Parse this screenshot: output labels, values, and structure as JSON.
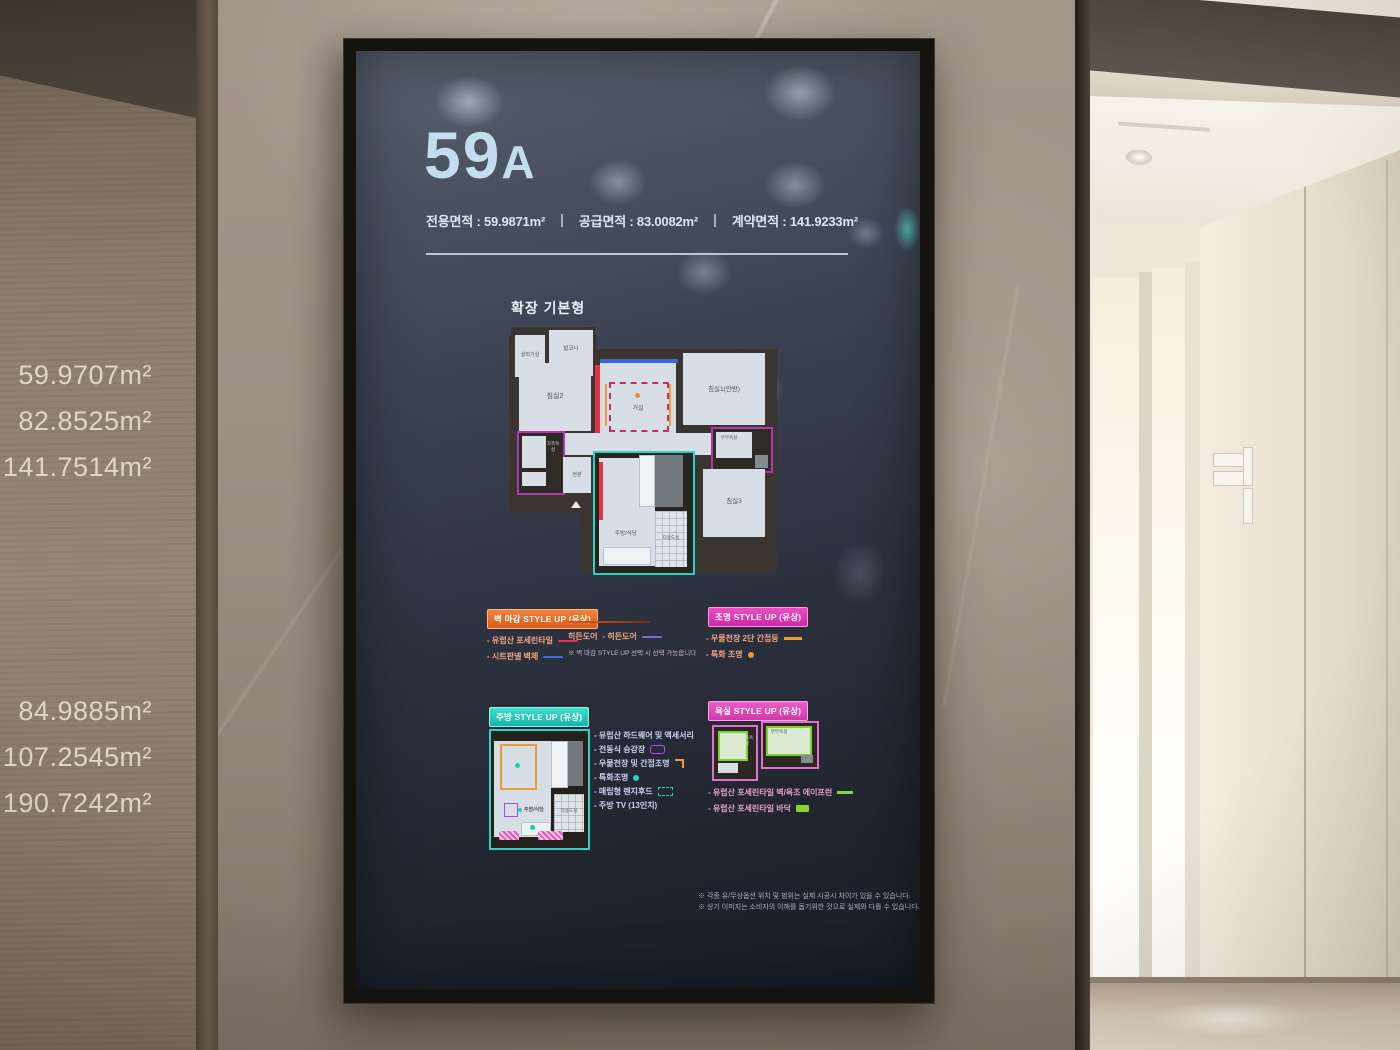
{
  "colors": {
    "wall_badge_orange": "#e8722b",
    "lighting_badge_magenta": "#d936b5",
    "kitchen_badge_teal": "#2dd2c2",
    "bath_badge_pink": "#dd4fb6",
    "swatch_red": "#e0344a",
    "swatch_blue": "#3f6fd8",
    "swatch_purple": "#8a5fd8",
    "swatch_orange": "#e8a032",
    "swatch_teal": "#23d0c0",
    "swatch_green": "#84d828",
    "screen_text": "#d9e7f3"
  },
  "left_wall": {
    "areas_top": [
      "59.9707m²",
      "82.8525m²",
      "141.7514m²"
    ],
    "areas_bottom": [
      "84.9885m²",
      "107.2545m²",
      "190.7242m²"
    ]
  },
  "screen": {
    "unit_number": "59",
    "unit_letter": "A",
    "area_items": [
      "전용면적 : 59.9871m²",
      "공급면적 : 83.0082m²",
      "계약면적 : 141.9233m²"
    ],
    "plan_title": "확장 기본형",
    "floorplan_rooms": {
      "outdoor_unit": "실외기실",
      "balcony": "발코니",
      "bed2": "침실2",
      "living": "거실",
      "bed1": "침실1(안방)",
      "family_bath": "가족욕실",
      "master_bath": "부부욕실",
      "entrance": "현관",
      "kitchen": "주방/식당",
      "utility": "다용도실",
      "bed3": "침실3"
    },
    "wall_legend": {
      "badge": "벽 마감 STYLE UP (유상)",
      "item1": "- 유럽산 포세린타일",
      "item2": "- 시트판넬 벽체",
      "hidden_door_title": "히든도어",
      "hidden_door_item": "- 히든도어",
      "note": "※ 벽 마감 STYLE UP 선택 시 선택 가능합니다"
    },
    "lighting_legend": {
      "badge": "조명 STYLE UP (유상)",
      "item1": "- 우물천장 2단 간접등",
      "item2": "- 특화 조명"
    },
    "kitchen_legend": {
      "badge": "주방 STYLE UP (유상)",
      "items": [
        "- 유럽산 하드웨어 및 액세서리",
        "- 전동식 승강장",
        "- 우물천장 및 간접조명",
        "- 특화조명",
        "- 매립형 렌지후드",
        "- 주방 TV (13인치)"
      ],
      "diagram": {
        "kitchen": "주방/식당",
        "utility": "다용도실"
      }
    },
    "bath_legend": {
      "badge": "욕실 STYLE UP (유상)",
      "item1": "- 유럽산 포세린타일 벽/욕조 에이프런",
      "item2": "- 유럽산 포세린타일 바닥",
      "diagram": {
        "family": "가족욕실",
        "master": "부부욕실"
      }
    },
    "disclaimers": [
      "※ 각종 유/무상옵션 위치 및 범위는 실제 시공시 차이가 있을 수 있습니다.",
      "※ 상기 이미지는 소비자의 이해를 돕기위한 것으로 실제와 다를 수 있습니다."
    ]
  }
}
